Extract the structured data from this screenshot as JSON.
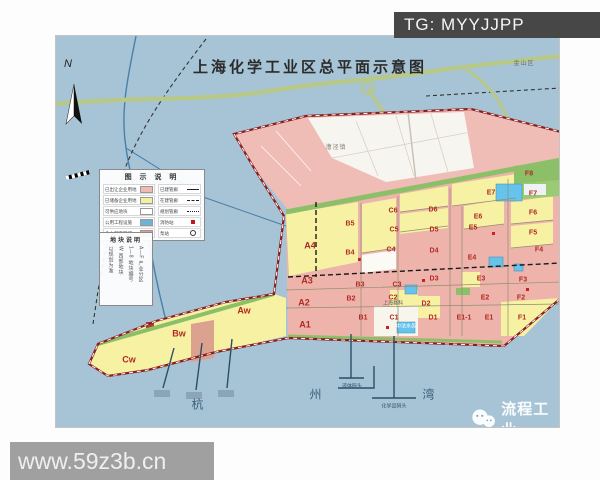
{
  "page": {
    "watermark_tg": "TG: MYYJJPP",
    "watermark_site": "www.59z3b.cn",
    "brand": "流程工业"
  },
  "map": {
    "title": "上海化学工业区总平面示意图",
    "compass_n": "N",
    "sea_name_chars": [
      "杭",
      "州",
      "湾"
    ],
    "legend": {
      "title": "图 示 说 明",
      "left": [
        {
          "label": "已出让企业用地",
          "swatch": "pink"
        },
        {
          "label": "已储备企业用地",
          "swatch": "yellow"
        },
        {
          "label": "可供应地块",
          "swatch": "white"
        },
        {
          "label": "公用工程设施",
          "swatch": "blue"
        },
        {
          "label": "金山配套区域",
          "swatch": "red"
        }
      ],
      "right": [
        {
          "label": "已建管廊",
          "symbol": "line"
        },
        {
          "label": "在建管廊",
          "symbol": "dash"
        },
        {
          "label": "规划管廊",
          "symbol": "dot"
        },
        {
          "label": "消防站",
          "symbol": "fire"
        },
        {
          "label": "泵站",
          "symbol": "pump"
        }
      ]
    },
    "plot_note": {
      "title": "地块说明",
      "columns": [
        "A—F 产业分区",
        "1—8 地块编号",
        "W 西部地块",
        "以规划为准"
      ]
    },
    "zones": [
      {
        "id": "A4",
        "x": 254,
        "y": 210,
        "big": true
      },
      {
        "id": "A3",
        "x": 251,
        "y": 245,
        "big": true
      },
      {
        "id": "A2",
        "x": 248,
        "y": 267,
        "big": true
      },
      {
        "id": "A1",
        "x": 249,
        "y": 289,
        "big": true
      },
      {
        "id": "Aw",
        "x": 188,
        "y": 275,
        "big": true
      },
      {
        "id": "Bw",
        "x": 123,
        "y": 298,
        "big": true
      },
      {
        "id": "Cw",
        "x": 73,
        "y": 324,
        "big": true
      },
      {
        "id": "B5",
        "x": 294,
        "y": 188
      },
      {
        "id": "B4",
        "x": 294,
        "y": 217
      },
      {
        "id": "B3",
        "x": 304,
        "y": 249
      },
      {
        "id": "B2",
        "x": 295,
        "y": 263
      },
      {
        "id": "B1",
        "x": 307,
        "y": 282
      },
      {
        "id": "C6",
        "x": 337,
        "y": 175
      },
      {
        "id": "C5",
        "x": 338,
        "y": 194
      },
      {
        "id": "C4",
        "x": 335,
        "y": 214
      },
      {
        "id": "C3",
        "x": 341,
        "y": 249
      },
      {
        "id": "C2",
        "x": 337,
        "y": 262
      },
      {
        "id": "C1",
        "x": 338,
        "y": 282
      },
      {
        "id": "D6",
        "x": 377,
        "y": 174
      },
      {
        "id": "D5",
        "x": 378,
        "y": 194
      },
      {
        "id": "D4",
        "x": 378,
        "y": 215
      },
      {
        "id": "D3",
        "x": 378,
        "y": 243
      },
      {
        "id": "D2",
        "x": 370,
        "y": 268
      },
      {
        "id": "D1",
        "x": 377,
        "y": 282
      },
      {
        "id": "E7",
        "x": 435,
        "y": 157
      },
      {
        "id": "E6",
        "x": 422,
        "y": 181
      },
      {
        "id": "E5",
        "x": 417,
        "y": 192
      },
      {
        "id": "E4",
        "x": 416,
        "y": 222
      },
      {
        "id": "E3",
        "x": 425,
        "y": 243
      },
      {
        "id": "E2",
        "x": 429,
        "y": 262
      },
      {
        "id": "E1-1",
        "x": 408,
        "y": 282
      },
      {
        "id": "E1",
        "x": 433,
        "y": 282
      },
      {
        "id": "F8",
        "x": 473,
        "y": 138
      },
      {
        "id": "F7",
        "x": 477,
        "y": 158
      },
      {
        "id": "F6",
        "x": 477,
        "y": 177
      },
      {
        "id": "F5",
        "x": 477,
        "y": 197
      },
      {
        "id": "F4",
        "x": 483,
        "y": 214
      },
      {
        "id": "F3",
        "x": 467,
        "y": 244
      },
      {
        "id": "F2",
        "x": 465,
        "y": 262
      },
      {
        "id": "F1",
        "x": 466,
        "y": 282
      }
    ],
    "place_labels": [
      {
        "text": "金山区",
        "x": 468,
        "y": 28,
        "cls": "district"
      },
      {
        "text": "漕泾镇",
        "x": 280,
        "y": 112,
        "cls": "town"
      },
      {
        "text": "上海赛科",
        "x": 337,
        "y": 268,
        "cls": ""
      },
      {
        "text": "中法水务",
        "x": 350,
        "y": 291,
        "cls": "onblue"
      },
      {
        "text": "液体码头",
        "x": 296,
        "y": 351,
        "cls": "pier"
      },
      {
        "text": "化学品码头",
        "x": 338,
        "y": 371,
        "cls": "pier"
      }
    ],
    "colors": {
      "water": "#a7c4d6",
      "parcel_pink": "#eeb3ab",
      "parcel_yellow": "#f6f1a3",
      "parcel_green": "#8cc068",
      "utility_blue": "#66c4ec",
      "border_red": "#8b1f1f",
      "road_green": "#b7c889",
      "zone_label_red": "#b22a22"
    }
  }
}
